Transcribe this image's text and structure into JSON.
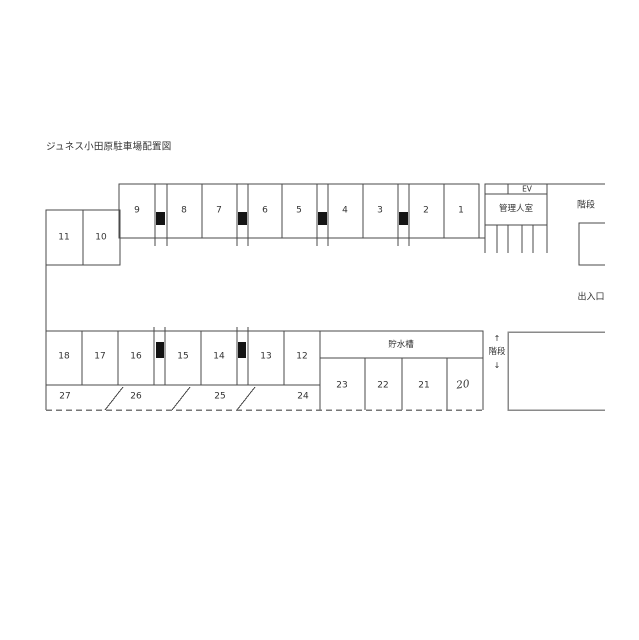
{
  "title": "ジュネス小田原駐車場配置図",
  "labels": {
    "ev": "EV",
    "manager_room": "管理人室",
    "stairs_upper": "階段",
    "entrance_exit": "出入口",
    "water_tank": "貯水槽",
    "stairs_lower_up_arrow": "↑",
    "stairs_lower": "階段",
    "stairs_lower_down_arrow": "↓"
  },
  "spaces": {
    "upper_row": [
      "9",
      "8",
      "7",
      "6",
      "5",
      "4",
      "3",
      "2",
      "1"
    ],
    "upper_left_block": [
      "11",
      "10"
    ],
    "lower_row": [
      "18",
      "17",
      "16",
      "15",
      "14",
      "13",
      "12"
    ],
    "tank_row": [
      "23",
      "22",
      "21",
      "20"
    ],
    "angled_row": [
      "27",
      "26",
      "25",
      "24"
    ]
  },
  "colors": {
    "background": "#ffffff",
    "line": "#4a4a4a",
    "pillar": "#141414",
    "text": "#333333"
  }
}
